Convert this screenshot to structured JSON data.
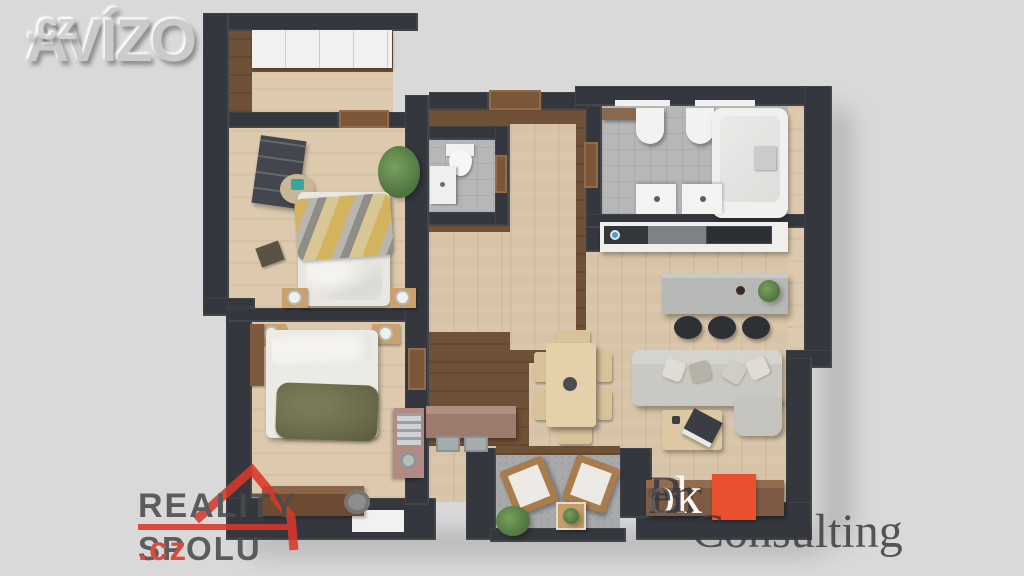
{
  "watermarks": {
    "avizo": {
      "name": "AVÍZO",
      "tld": ".cz"
    },
    "reality_spolu": {
      "line1": "REALITY",
      "line2": "SPOLU",
      "tld": ".cz"
    },
    "broker_consulting": {
      "word1_pre": "Br",
      "word1_mid": "ok",
      "word1_post": "er",
      "registered": "®",
      "word2": "Consulting"
    }
  },
  "palette": {
    "background": "#d9d9d9",
    "wall": "#34373d",
    "wood_floor": "#d7c3a7",
    "hall_dark_wood": "#6f5138",
    "tile_floor": "#b5b7b9",
    "balcony_floor": "#a7a9ab",
    "white_fixture": "#f1f1ef",
    "sofa_gray": "#c9c8c3",
    "island_gray": "#b5b8b4",
    "door_brown": "#7b5639",
    "blanket_yellow": "#d3b35e",
    "blanket_olive": "#6a6c4b",
    "plant_green": "#5d8049",
    "teal_accent": "#35a79f",
    "sideboard_brown": "#7c5a44",
    "desk_mauve": "#b18b82",
    "reality_red": "#d9382a",
    "broker_orange": "#e8502e"
  }
}
